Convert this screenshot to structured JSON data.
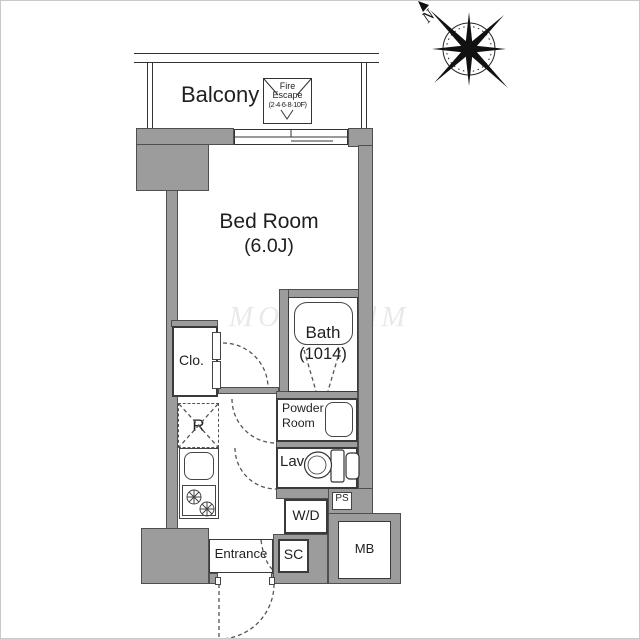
{
  "plan": {
    "compass_label": "N",
    "balcony_label": "Balcony",
    "fire_escape": {
      "line1": "Fire",
      "line2": "Escape",
      "line3": "(2·4·6·8·10F)"
    },
    "bedroom": {
      "name": "Bed Room",
      "size": "(6.0J)"
    },
    "bath": {
      "name": "Bath",
      "size": "(1014)"
    },
    "closet_label": "Clo.",
    "fridge_label": "R",
    "powder_room": {
      "line1": "Powder",
      "line2": "Room"
    },
    "lav_label": "Lav.",
    "wd_label": "W/D",
    "ps_label": "PS",
    "entrance_label": "Entrance",
    "sc_label": "SC",
    "mb_label": "MB",
    "watermark": "MOOOOdM"
  },
  "colors": {
    "wall_fill": "#9c9c9c",
    "wall_outline": "#4f4f4f",
    "line": "#3a3a3a",
    "text": "#1f1f1f"
  }
}
